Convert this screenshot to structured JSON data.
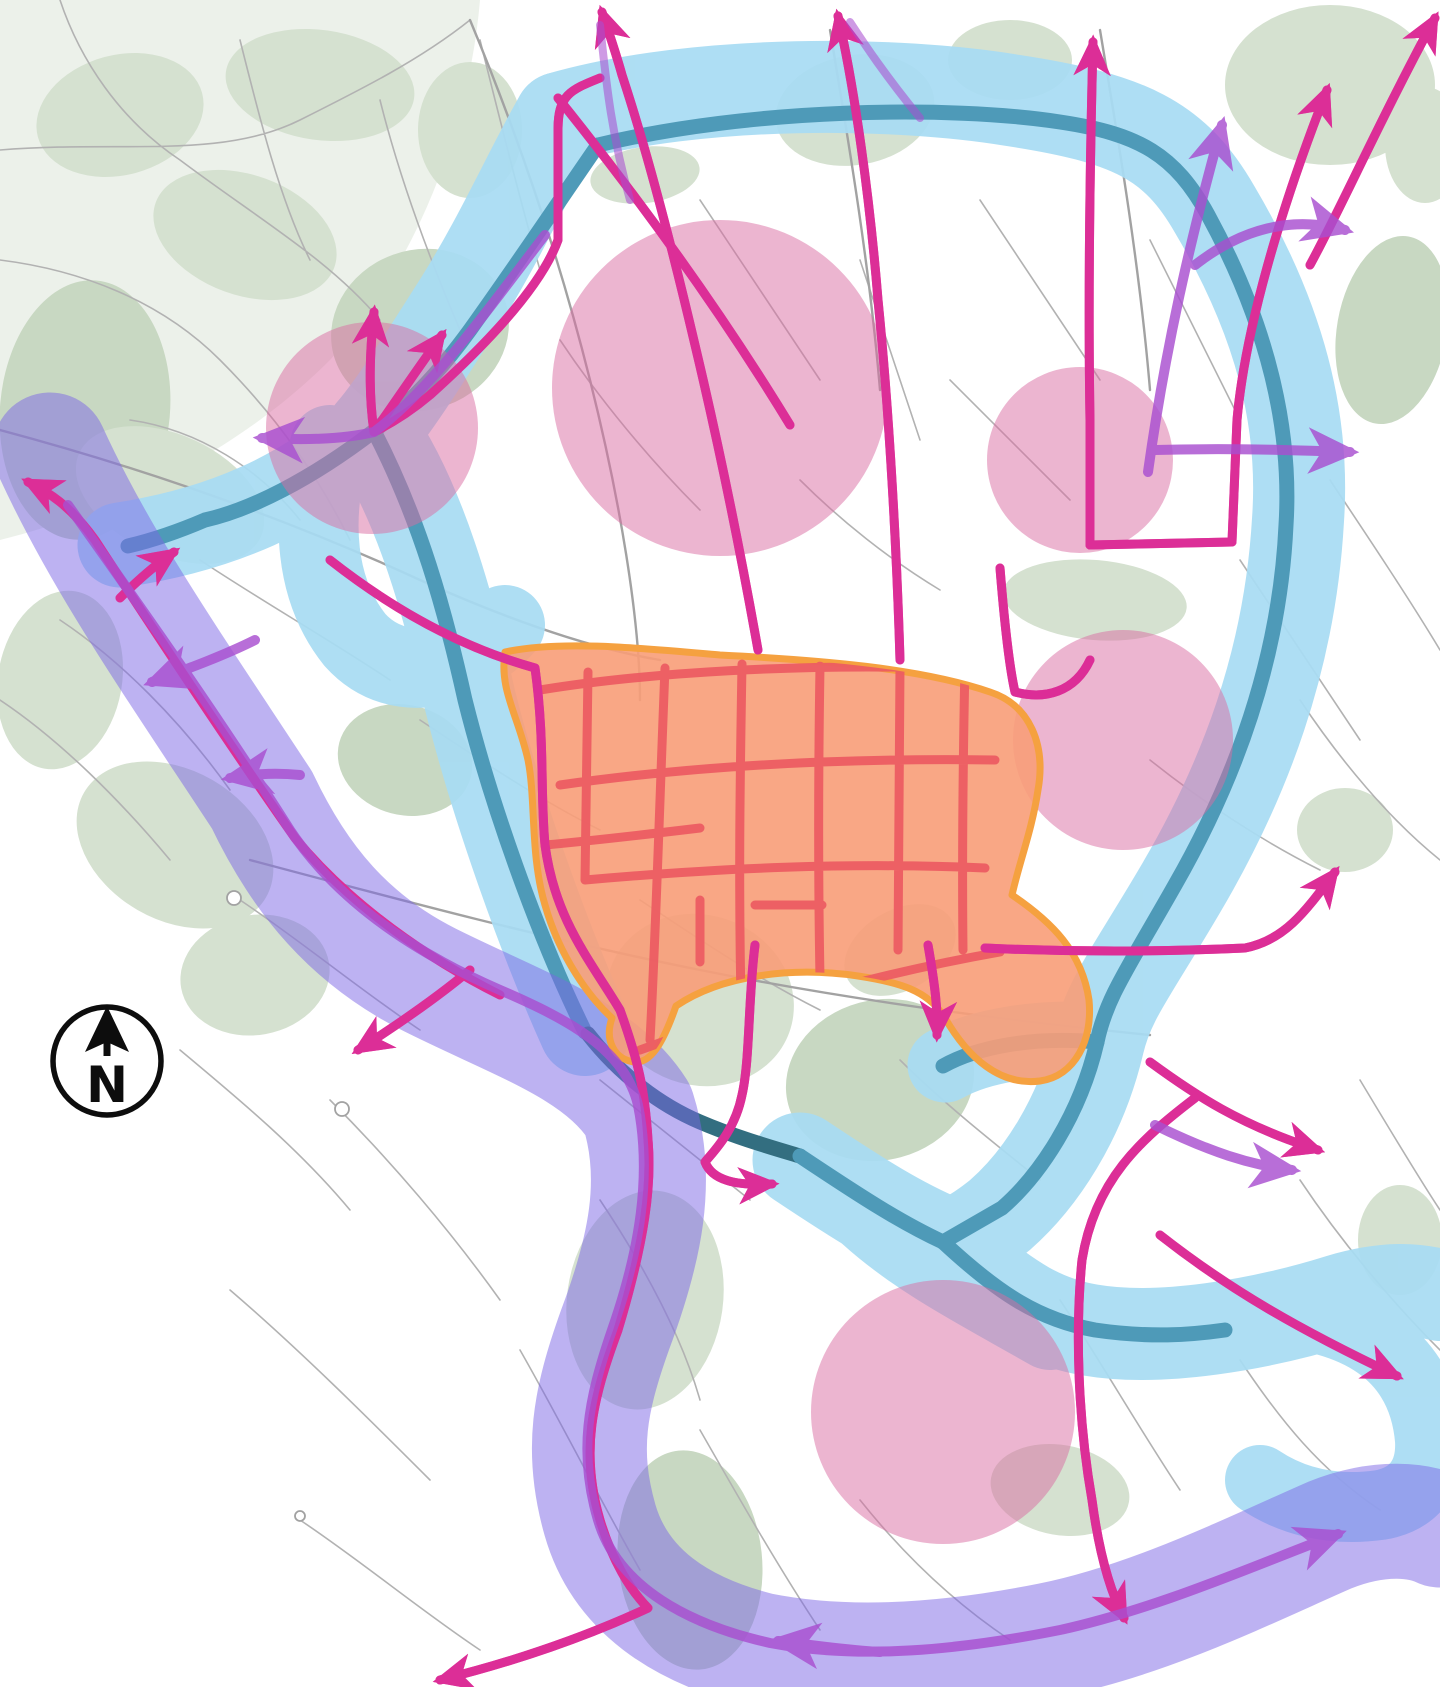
{
  "map": {
    "compass": {
      "label": "N"
    },
    "colors": {
      "background": "#ffffff",
      "park_green": "#d5e1d0",
      "park_green_dark": "#c8d8c2",
      "road_gray": "#b2b2b2",
      "road_gray_major": "#a2a2a2",
      "blue_corridor": "#a8dcf3",
      "ring_road_teal": "#4e9ab8",
      "ring_road_dark": "#336e80",
      "pink_node": "#d96ca2",
      "purple_corridor": "#7c66e6",
      "purple_route": "#a94fd0",
      "magenta_route": "#dc2e97",
      "magenta_core": "#f387c7",
      "orange_zone_fill": "#f89d78",
      "orange_zone_border": "#f5a140",
      "centre_street_red": "#ec5a62",
      "compass_ink": "#0d0d0d"
    },
    "district_nodes": [
      {
        "cx": 720,
        "cy": 388,
        "r": 168
      },
      {
        "cx": 372,
        "cy": 428,
        "r": 106
      },
      {
        "cx": 1080,
        "cy": 460,
        "r": 93
      },
      {
        "cx": 1123,
        "cy": 740,
        "r": 110
      },
      {
        "cx": 943,
        "cy": 1412,
        "r": 132
      }
    ],
    "layer_names": [
      "park-areas",
      "street-network",
      "blue-corridor-band",
      "ring-road-line",
      "district-node-circles",
      "purple-corridor-band",
      "purple-route-lines",
      "city-centre-zone",
      "centre-street-network",
      "magenta-route-network",
      "north-compass"
    ]
  }
}
